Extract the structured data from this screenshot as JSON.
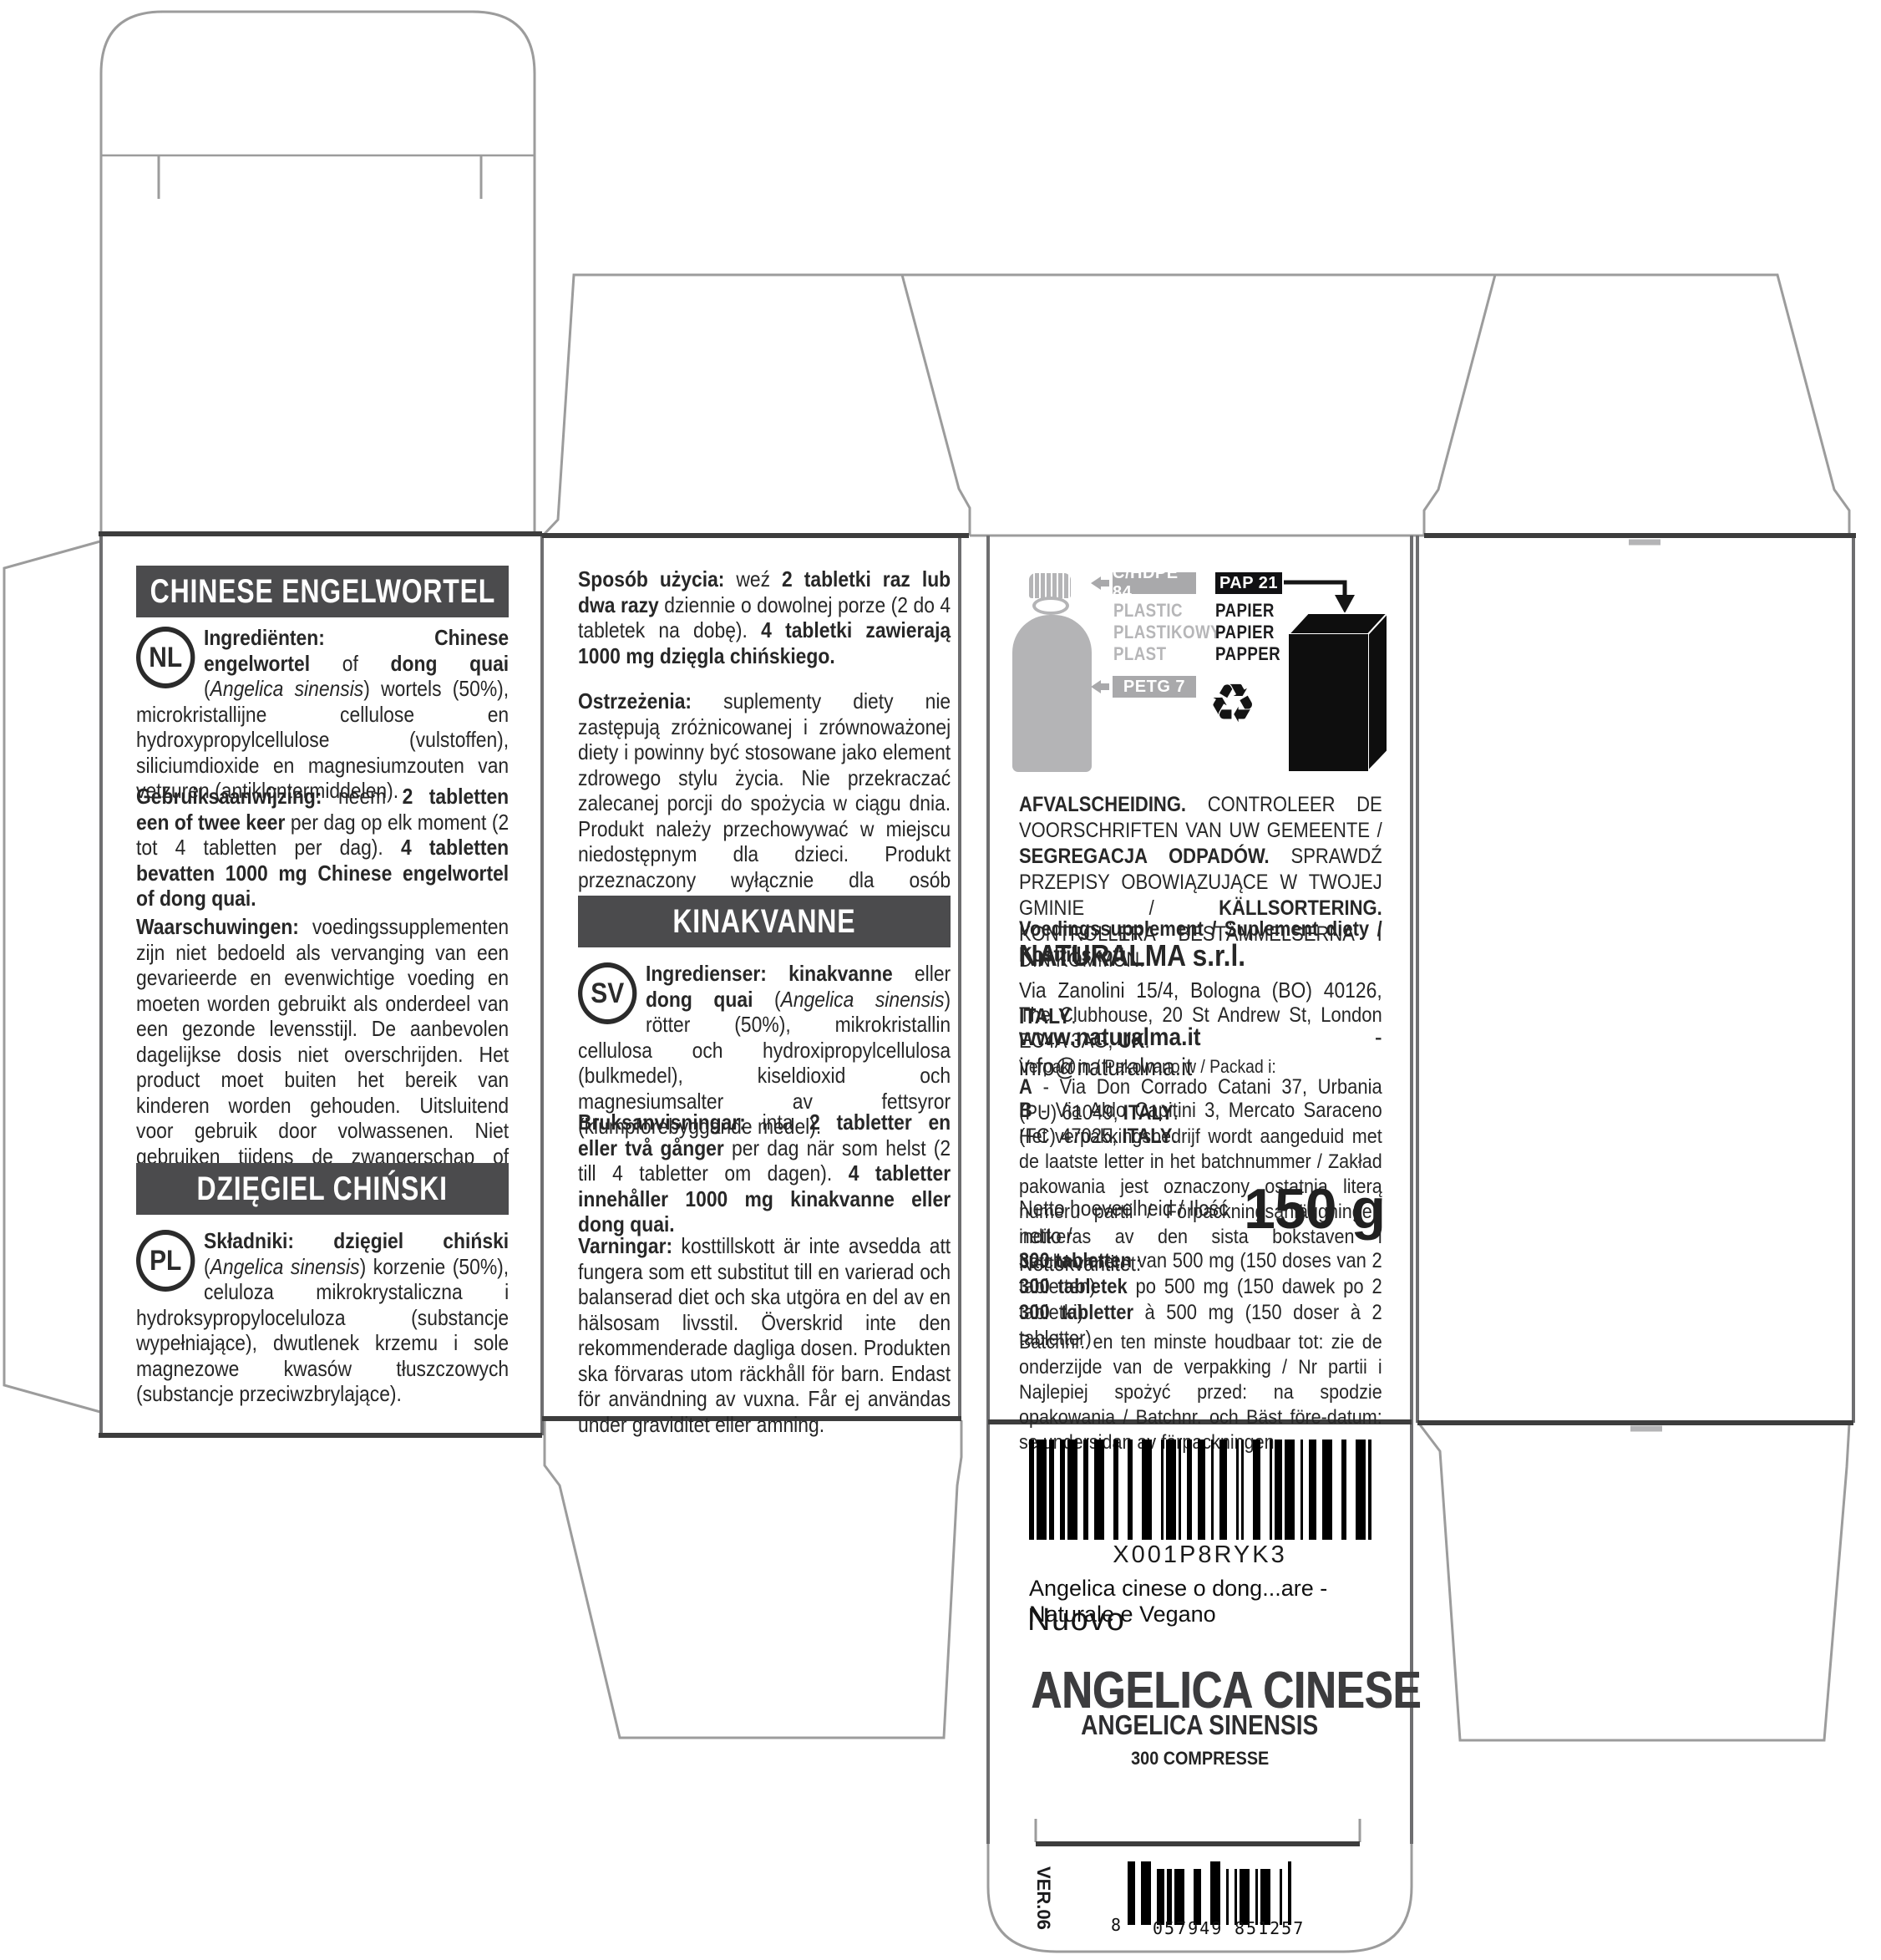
{
  "meta": {
    "kind": "supplement packaging dieline",
    "version_code": "VER.06"
  },
  "colors": {
    "heading_bar": "#4b4b4d",
    "badge_gray": "#a9a9ab",
    "badge_black": "#111113",
    "graphic_gray": "#b4b4b6"
  },
  "panel_nl_pl": {
    "heading_nl": "CHINESE ENGELWORTEL",
    "lang_nl": "NL",
    "nl_ingredients": [
      {
        "t": "Ingrediënten: Chinese engelwortel",
        "s": "b"
      },
      {
        "t": " of ",
        "s": ""
      },
      {
        "t": "dong quai",
        "s": "b"
      },
      {
        "t": " (",
        "s": ""
      },
      {
        "t": "Angelica sinensis",
        "s": "i"
      },
      {
        "t": ") wortels (50%), microkristallijne cellulose en hydroxypropylcellulose (vulstoffen), siliciumdioxide en magnesiumzouten van vetzuren (antiklontermiddelen).",
        "s": ""
      }
    ],
    "nl_usage": [
      {
        "t": "Gebruiksaanwijzing:",
        "s": "b"
      },
      {
        "t": " neem ",
        "s": ""
      },
      {
        "t": "2 tabletten een of twee keer",
        "s": "b"
      },
      {
        "t": " per dag op elk moment (2 tot 4 tabletten per dag). ",
        "s": ""
      },
      {
        "t": "4 tabletten bevatten 1000 mg Chinese engelwortel of dong quai.",
        "s": "b"
      }
    ],
    "nl_warnings": [
      {
        "t": "Waarschuwingen:",
        "s": "b"
      },
      {
        "t": " voedingssupplementen zijn niet bedoeld als vervanging van een gevarieerde en evenwichtige voeding en moeten worden gebruikt als onderdeel van een gezonde levensstijl. De aanbevolen dagelijkse dosis niet overschrijden. Het product moet buiten het bereik van kinderen worden gehouden. Uitsluitend voor gebruik door volwassenen. Niet gebruiken tijdens de zwangerschap of indien u borstvoeding geeft.",
        "s": ""
      }
    ],
    "heading_pl": "DZIĘGIEL CHIŃSKI",
    "lang_pl": "PL",
    "pl_ingredients": [
      {
        "t": "Składniki: dzięgiel chiński",
        "s": "b"
      },
      {
        "t": " (",
        "s": ""
      },
      {
        "t": "Angelica sinensis",
        "s": "i"
      },
      {
        "t": ") korzenie (50%), celuloza mikrokrystaliczna i hydroksypropyloceluloza (substancje wypełniające), dwutlenek krzemu i sole magnezowe kwasów tłuszczowych (substancje przeciwzbrylające).",
        "s": ""
      }
    ]
  },
  "panel_pl_sv": {
    "pl_usage": [
      {
        "t": "Sposób użycia:",
        "s": "b"
      },
      {
        "t": " weź ",
        "s": ""
      },
      {
        "t": "2 tabletki raz lub dwa razy",
        "s": "b"
      },
      {
        "t": " dziennie o dowolnej porze (2 do 4 tabletek na dobę). ",
        "s": ""
      },
      {
        "t": "4 tabletki zawierają 1000 mg dzięgla chińskiego.",
        "s": "b"
      }
    ],
    "pl_warnings": [
      {
        "t": "Ostrzeżenia:",
        "s": "b"
      },
      {
        "t": " suplementy diety nie zastępują zróżnicowanej i zrównoważonej diety i powinny być stosowane jako element zdrowego stylu życia. Nie przekraczać zalecanej porcji do spożycia w ciągu dnia. Produkt należy przechowywać w miejscu niedostępnym dla dzieci. Produkt przeznaczony wyłącznie dla osób dorosłych. Nie stosować w okresie ciąży i karmienia piersią.",
        "s": ""
      }
    ],
    "heading_sv": "KINAKVANNE",
    "lang_sv": "SV",
    "sv_ingredients": [
      {
        "t": "Ingredienser: kinakvanne",
        "s": "b"
      },
      {
        "t": " eller ",
        "s": ""
      },
      {
        "t": "dong quai",
        "s": "b"
      },
      {
        "t": " (",
        "s": ""
      },
      {
        "t": "Angelica sinensis",
        "s": "i"
      },
      {
        "t": ") rötter (50%), mikrokristallin cellulosa och hydroxipropylcellulosa (bulkmedel), kiseldioxid och magnesiumsalter av fettsyror (klumpförebyggande medel).",
        "s": ""
      }
    ],
    "sv_usage": [
      {
        "t": "Bruksanvisningar:",
        "s": "b"
      },
      {
        "t": " inta ",
        "s": ""
      },
      {
        "t": "2 tabletter en eller två gånger",
        "s": "b"
      },
      {
        "t": " per dag när som helst (2 till 4 tabletter om dagen). ",
        "s": ""
      },
      {
        "t": "4 tabletter innehåller 1000 mg kinakvanne eller dong quai.",
        "s": "b"
      }
    ],
    "sv_warnings": [
      {
        "t": "Varningar:",
        "s": "b"
      },
      {
        "t": " kosttillskott är inte avsedda att fungera som ett substitut till en varierad och balanserad diet och ska utgöra en del av en hälsosam livsstil. Överskrid inte den rekommenderade dagliga dosen. Produkten ska förvaras utom räckhåll för barn. Endast för användning av vuxna. Får ej användas under graviditet eller amning.",
        "s": ""
      }
    ]
  },
  "panel_info": {
    "plastic_badge": "C/HDPE 84",
    "plastic_words": [
      "PLASTIC",
      "PLASTIKOWY",
      "PLAST"
    ],
    "petg_badge": "PETG 7",
    "pap_badge": "PAP 21",
    "paper_words": [
      "PAPIER",
      "PAPIER",
      "PAPPER"
    ],
    "recycle_icon": "♻",
    "sorting": [
      {
        "t": "AFVALSCHEIDING.",
        "s": "b"
      },
      {
        "t": " CONTROLEER DE VOORSCHRIFTEN VAN UW GEMEENTE / ",
        "s": ""
      },
      {
        "t": "SEGREGACJA ODPADÓW.",
        "s": "b"
      },
      {
        "t": " SPRAWDŹ PRZEPISY OBOWIĄZUJĄCE W TWOJEJ GMINIE / ",
        "s": ""
      },
      {
        "t": "KÄLLSORTERING.",
        "s": "b"
      },
      {
        "t": " KONTROLLERA BESTÄMMELSERNA I DIN KOMMUN.",
        "s": ""
      }
    ],
    "supplement_line": [
      {
        "t": "Voedingssupplement / Suplement diety / Kosttillskott",
        "s": "b"
      }
    ],
    "company": [
      {
        "t": "NATURALMA s.r.l.",
        "s": "b"
      }
    ],
    "address1": [
      {
        "t": "Via Zanolini 15/4, Bologna (BO) 40126, ",
        "s": ""
      },
      {
        "t": "ITALY",
        "s": "b"
      },
      {
        "t": ".",
        "s": ""
      }
    ],
    "address2": [
      {
        "t": "The Clubhouse, 20 St Andrew St, London EC4A 3AG, ",
        "s": ""
      },
      {
        "t": "UK",
        "s": "b"
      },
      {
        "t": ".",
        "s": ""
      }
    ],
    "website": [
      {
        "t": "www.naturalma.it",
        "s": "b"
      },
      {
        "t": " - info@naturalma.it",
        "s": ""
      }
    ],
    "packed_label": [
      {
        "t": "Verpakt in / Pakowano w / Packad i:",
        "s": ""
      }
    ],
    "packed_a": [
      {
        "t": "A",
        "s": "b"
      },
      {
        "t": " - Via Don Corrado Catani 37, Urbania (PU) 61049, ",
        "s": ""
      },
      {
        "t": "ITALY",
        "s": "b"
      },
      {
        "t": ".",
        "s": ""
      }
    ],
    "packed_b": [
      {
        "t": "B",
        "s": "b"
      },
      {
        "t": " - Via Aldo Capitini 3, Mercato Saraceno (FC) 47025, ",
        "s": ""
      },
      {
        "t": "ITALY",
        "s": "b"
      },
      {
        "t": ".",
        "s": ""
      }
    ],
    "batch_note": [
      {
        "t": "Het verpakkingsbedrijf wordt aangeduid met de laatste letter in het batchnummer / Zakład pakowania jest oznaczony ostatnią literą numeru partii / Förpackningsanläggningen indikeras av den sista bokstaven i batchnumret.",
        "s": ""
      }
    ],
    "net_label_1": "Netto hoeveelheid / Ilość netto /",
    "net_label_2": "Nettokvantitet:",
    "net_value": "150 g",
    "tablets_nl": [
      {
        "t": "300 tabletten",
        "s": "b"
      },
      {
        "t": " van 500 mg (150 doses van 2 tabletten)",
        "s": ""
      }
    ],
    "tablets_pl": [
      {
        "t": "300 tabletek",
        "s": "b"
      },
      {
        "t": " po 500 mg (150 dawek po 2 tabletki)",
        "s": ""
      }
    ],
    "tablets_sv": [
      {
        "t": "300 tabletter",
        "s": "b"
      },
      {
        "t": " à 500 mg (150 doser à 2 tabletter)",
        "s": ""
      }
    ],
    "batch_bottom": [
      {
        "t": "Batchnr. en ten minste houdbaar tot: zie de onderzijde van de verpakking / Nr partii i Najlepiej spożyć przed: na spodzie opakowania / Batchnr. och Bäst före-datum: se undersidan av förpackningen.",
        "s": ""
      }
    ]
  },
  "panel_front": {
    "barcode_text": "X001P8RYK3",
    "listing_line": "Angelica cinese o dong...are - Naturale e Vegano",
    "listing_badge": "Nuovo",
    "product_name": "ANGELICA CINESE",
    "product_latin": "ANGELICA SINENSIS",
    "product_count": "300 COMPRESSE",
    "version": "VER.06",
    "ean_digit_first": "8",
    "ean_group_1": "057949",
    "ean_group_2": "851257"
  }
}
